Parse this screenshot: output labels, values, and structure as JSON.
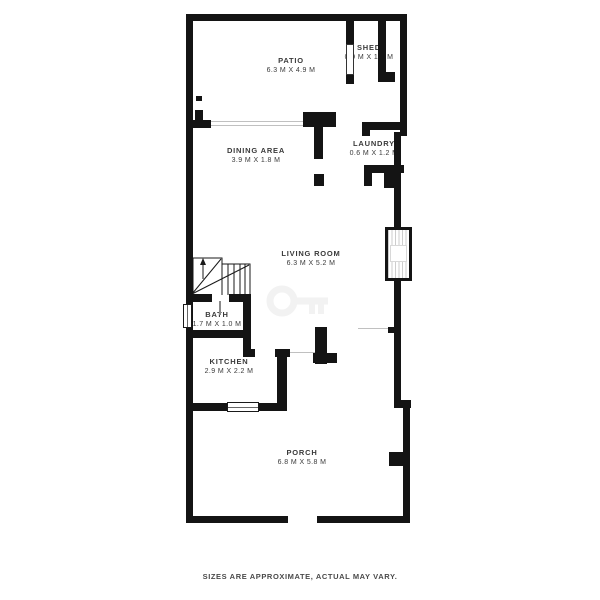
{
  "colors": {
    "bg": "#ffffff",
    "wall": "#141414",
    "label": "#3a3a3a",
    "muted": "#4a4a4a",
    "opening": "#c0c0c0",
    "watermark": "#f2f2f2"
  },
  "rooms": [
    {
      "name": "PATIO",
      "dims": "6.3 M X 4.9 M"
    },
    {
      "name": "SHED",
      "dims": "0.9 M X 1.8 M"
    },
    {
      "name": "DINING AREA",
      "dims": "3.9 M X 1.8 M"
    },
    {
      "name": "LAUNDRY",
      "dims": "0.6 M X 1.2 M"
    },
    {
      "name": "LIVING ROOM",
      "dims": "6.3 M X 5.2 M"
    },
    {
      "name": "BATH",
      "dims": "1.7 M X 1.0 M"
    },
    {
      "name": "KITCHEN",
      "dims": "2.9 M X 2.2 M"
    },
    {
      "name": "PORCH",
      "dims": "6.8 M X 5.8 M"
    }
  ],
  "footer": {
    "disclaimer": "SIZES ARE APPROXIMATE, ACTUAL MAY VARY."
  }
}
